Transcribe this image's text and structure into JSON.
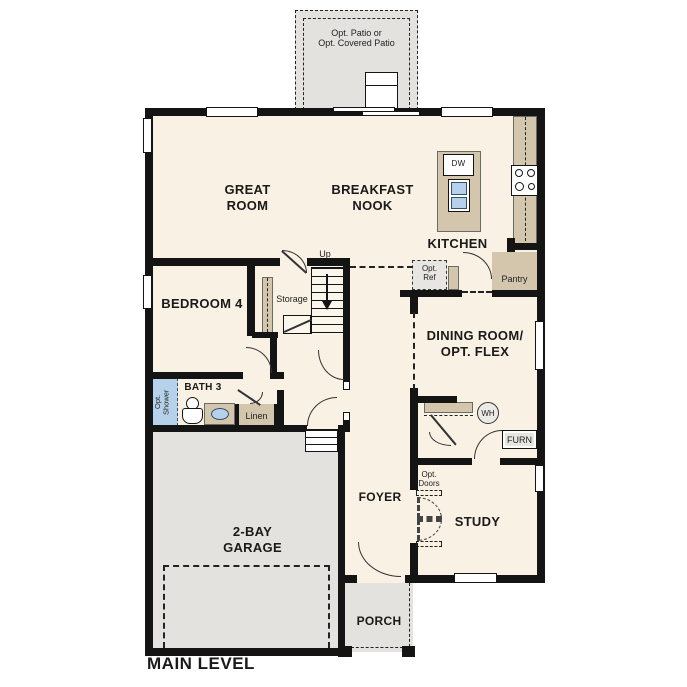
{
  "plan": {
    "title": "MAIN LEVEL",
    "labels": {
      "patio": "Opt. Patio or\nOpt. Covered Patio",
      "great_room": "GREAT\nROOM",
      "breakfast_nook": "BREAKFAST\nNOOK",
      "kitchen": "KITCHEN",
      "dishwasher": "DW",
      "opt_ref": "Opt.\nRef",
      "pantry": "Pantry",
      "up": "Up",
      "storage": "Storage",
      "bedroom4": "BEDROOM 4",
      "bath3": "BATH 3",
      "opt_shower": "Opt.\nShower",
      "linen": "Linen",
      "dining": "DINING ROOM/\nOPT. FLEX",
      "water_heater": "WH",
      "furnace": "FURN",
      "foyer": "FOYER",
      "opt_doors": "Opt.\nDoors",
      "study": "STUDY",
      "garage": "2-BAY\nGARAGE",
      "porch": "PORCH"
    },
    "colors": {
      "floor": "#f8f1e4",
      "outdoor": "#e3e2df",
      "cabinet": "#d3c6ac",
      "water": "#b5d2ea",
      "wall": "#141414"
    }
  }
}
